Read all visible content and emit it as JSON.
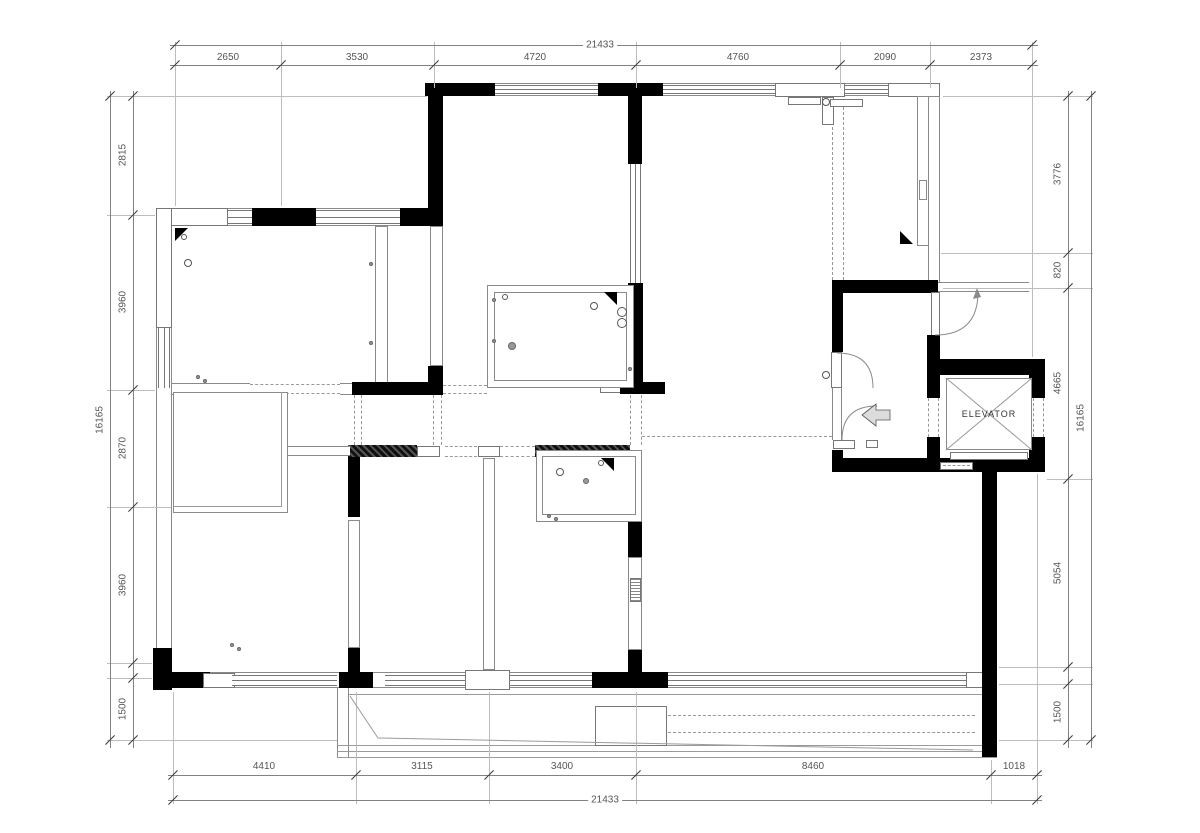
{
  "plan": {
    "elevator_label": "ELEVATOR"
  },
  "dims": {
    "top": {
      "total": "21433",
      "segments": [
        "2650",
        "3530",
        "4720",
        "4760",
        "2090",
        "2373"
      ]
    },
    "bottom": {
      "total": "21433",
      "segments": [
        "4410",
        "3115",
        "3400",
        "8460",
        "1018"
      ]
    },
    "left": {
      "total": "16165",
      "segments": [
        "2815",
        "3960",
        "2870",
        "3960",
        "1500"
      ]
    },
    "right": {
      "total": "16165",
      "segments": [
        "3776",
        "820",
        "4665",
        "5054",
        "1500"
      ]
    }
  },
  "colors": {
    "wall": "#000000",
    "thin_line": "#888888",
    "dim_text": "#555555",
    "dashed": "#999999"
  }
}
